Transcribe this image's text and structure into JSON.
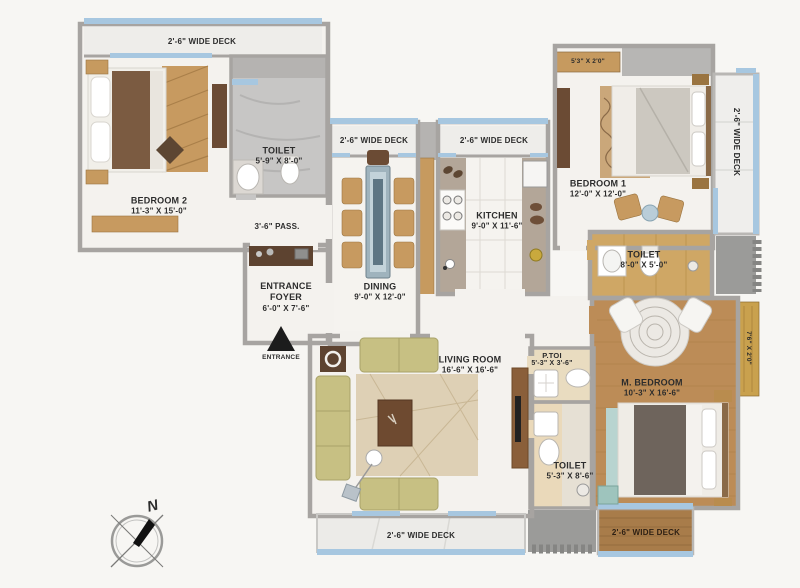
{
  "plan": {
    "rooms": {
      "bedroom2": {
        "name": "BEDROOM 2",
        "dims": "11'-3\" X 15'-0\""
      },
      "toilet_bedroom2": {
        "name": "TOILET",
        "dims": "5'-9\" X 8'-0\""
      },
      "passage": {
        "name": "3'-6\" PASS."
      },
      "entrance_foyer": {
        "name": "ENTRANCE FOYER",
        "dims": "6'-0\" X 7'-6\""
      },
      "entrance_marker": {
        "name": "ENTRANCE"
      },
      "dining": {
        "name": "DINING",
        "dims": "9'-0\" X 12'-0\""
      },
      "kitchen": {
        "name": "KITCHEN",
        "dims": "9'-0\" X 11'-6\""
      },
      "bedroom1": {
        "name": "BEDROOM 1",
        "dims": "12'-0\" X 12'-0\""
      },
      "bedroom1_ledge": {
        "dims": "5'3\" X 2'0\""
      },
      "toilet_bedroom1": {
        "name": "TOILET",
        "dims": "8'-0\" X 5'-0\""
      },
      "m_bedroom": {
        "name": "M. BEDROOM",
        "dims": "10'-3\" X 16'-6\""
      },
      "m_bedroom_ledge": {
        "dims": "7'6\" X 2'0\""
      },
      "living_room": {
        "name": "LIVING ROOM",
        "dims": "16'-6\" X 16'-6\""
      },
      "p_toi": {
        "name": "P.TOI",
        "dims": "5'-3\" X 3'-6\""
      },
      "toilet_common": {
        "name": "TOILET",
        "dims": "5'-3\" X 8'-6\""
      }
    },
    "decks": {
      "top": "2'-6\" WIDE DECK",
      "dining": "2'-6\" WIDE DECK",
      "kitchen": "2'-6\" WIDE DECK",
      "right": "2'-6\" WIDE DECK",
      "bottom": "2'-6\" WIDE DECK",
      "bottom_right": "2'-6\" WIDE DECK"
    },
    "compass": {
      "north": "N"
    },
    "colors": {
      "wall": "#a7a4a1",
      "deck_rail": "#a7c7e0",
      "floor": "#f4f2ee",
      "wood_floor": "#bc8c57",
      "accent_tan": "#c69a5f",
      "sofa_khaki": "#c7c083",
      "dark_wood": "#5f4431",
      "gold_ledge": "#c9a14e"
    }
  }
}
